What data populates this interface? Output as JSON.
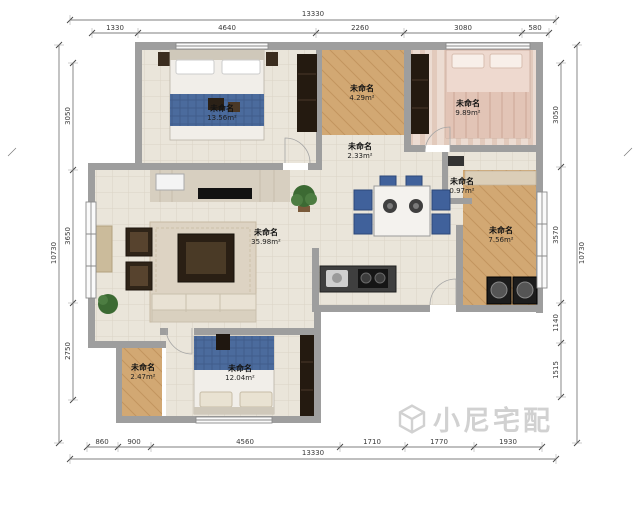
{
  "rooms": [
    {
      "id": "bedroom-top-left",
      "name": "未命名",
      "area": "13.56m²"
    },
    {
      "id": "room-top-middle",
      "name": "未命名",
      "area": "4.29m²"
    },
    {
      "id": "bedroom-top-right",
      "name": "未命名",
      "area": "9.89m²"
    },
    {
      "id": "hallway",
      "name": "未命名",
      "area": "2.33m²"
    },
    {
      "id": "entry-nook",
      "name": "未命名",
      "area": "0.97m²"
    },
    {
      "id": "room-right",
      "name": "未命名",
      "area": "7.56m²"
    },
    {
      "id": "living-room",
      "name": "未命名",
      "area": "35.98m²"
    },
    {
      "id": "room-bottom-left",
      "name": "未命名",
      "area": "2.47m²"
    },
    {
      "id": "bedroom-bottom",
      "name": "未命名",
      "area": "12.04m²"
    }
  ],
  "dimensions": {
    "top": {
      "overall": "13330",
      "segments": [
        "1330",
        "4640",
        "2260",
        "3080",
        "580"
      ]
    },
    "bottom": {
      "overall": "13330",
      "segments": [
        "860",
        "900",
        "4560",
        "1710",
        "1770",
        "1930"
      ]
    },
    "left": {
      "overall": "10730",
      "segments": [
        "3050",
        "3650",
        "2750"
      ]
    },
    "right": {
      "overall": "10730",
      "segments": [
        "3050",
        "3570",
        "1140",
        "1515"
      ]
    }
  },
  "watermark": {
    "text": "小尼宅配"
  },
  "colors": {
    "wall": "#9e9e9e",
    "tile": "#eae5da",
    "wood": "#d2a873",
    "accent_blue": "#40619b"
  }
}
